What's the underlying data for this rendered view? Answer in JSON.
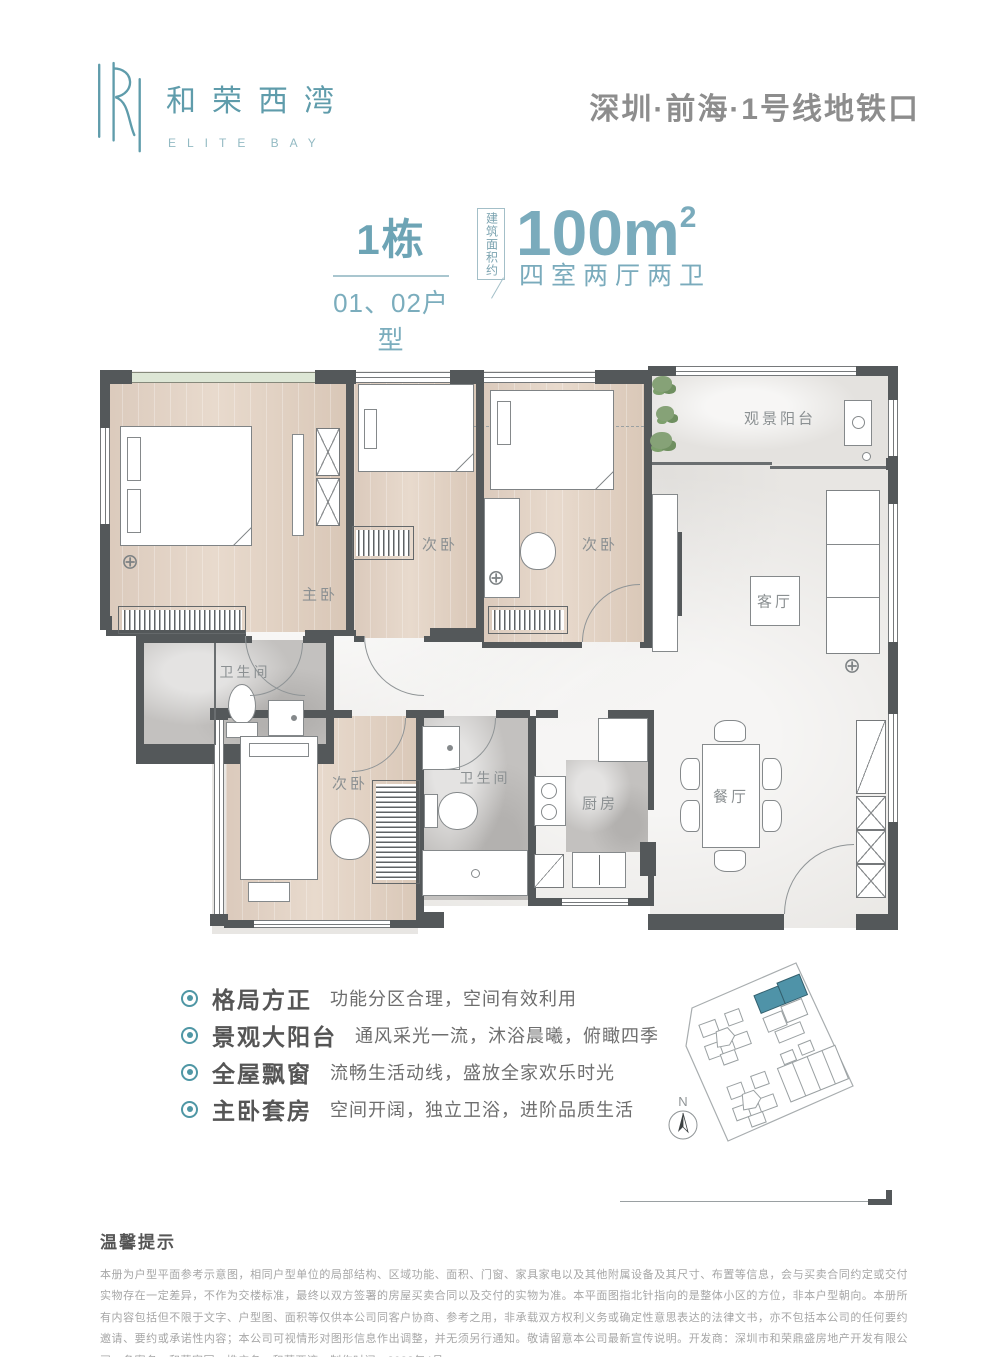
{
  "brand": {
    "monogram": "R",
    "name_cn": "和荣西湾",
    "name_en": "ELITE BAY",
    "accent": "#5f9cab"
  },
  "header": {
    "location": "深圳·前海·1号线地铁口"
  },
  "unit": {
    "building": "1栋",
    "units": "01、02户型",
    "area_prefix": "建筑面积约",
    "area_value": "100m",
    "area_sup": "2",
    "layout": "四室两厅两卫",
    "accent": "#79aabb"
  },
  "floorplan": {
    "rooms": [
      {
        "id": "balcony",
        "label": "观景阳台"
      },
      {
        "id": "master-bedroom",
        "label": "主卧"
      },
      {
        "id": "bedroom-2",
        "label": "次卧"
      },
      {
        "id": "bedroom-3",
        "label": "次卧"
      },
      {
        "id": "living-room",
        "label": "客厅"
      },
      {
        "id": "bathroom-1",
        "label": "卫生间"
      },
      {
        "id": "bedroom-4",
        "label": "次卧"
      },
      {
        "id": "bathroom-2",
        "label": "卫生间"
      },
      {
        "id": "kitchen",
        "label": "厨房"
      },
      {
        "id": "dining-room",
        "label": "餐厅"
      }
    ],
    "symbols": {
      "crosshair": "⊕"
    }
  },
  "features": [
    {
      "title": "格局方正",
      "desc": "功能分区合理，空间有效利用"
    },
    {
      "title": "景观大阳台",
      "desc": "通风采光一流，沐浴晨曦，俯瞰四季"
    },
    {
      "title": "全屋飘窗",
      "desc": "流畅生活动线，盛放全家欢乐时光"
    },
    {
      "title": "主卧套房",
      "desc": "空间开阔，独立卫浴，进阶品质生活"
    }
  ],
  "siteplan": {
    "compass_label": "N",
    "highlight_color": "#4f93a8"
  },
  "disclaimer": {
    "title": "温馨提示",
    "body": "本册为户型平面参考示意图，相同户型单位的局部结构、区域功能、面积、门窗、家具家电以及其他附属设备及其尺寸、布置等信息，会与买卖合同约定或交付实物存在一定差异，不作为交楼标准，最终以双方签署的房屋买卖合同以及交付的实物为准。本平面图指北针指向的是整体小区的方位，非本户型朝向。本册所有内容包括但不限于文字、户型图、面积等仅供本公司同客户协商、参考之用，非承载双方权利义务或确定性意思表达的法律文书，亦不包括本公司的任何要约邀请、要约或承诺性内容；本公司可视情形对图形信息作出调整，并无须另行通知。敬请留意本公司最新宣传说明。开发商：深圳市和荣鼎盛房地产开发有限公司；备案名：和荣家园；推广名：和荣西湾；制作时间：2023年4月"
  }
}
